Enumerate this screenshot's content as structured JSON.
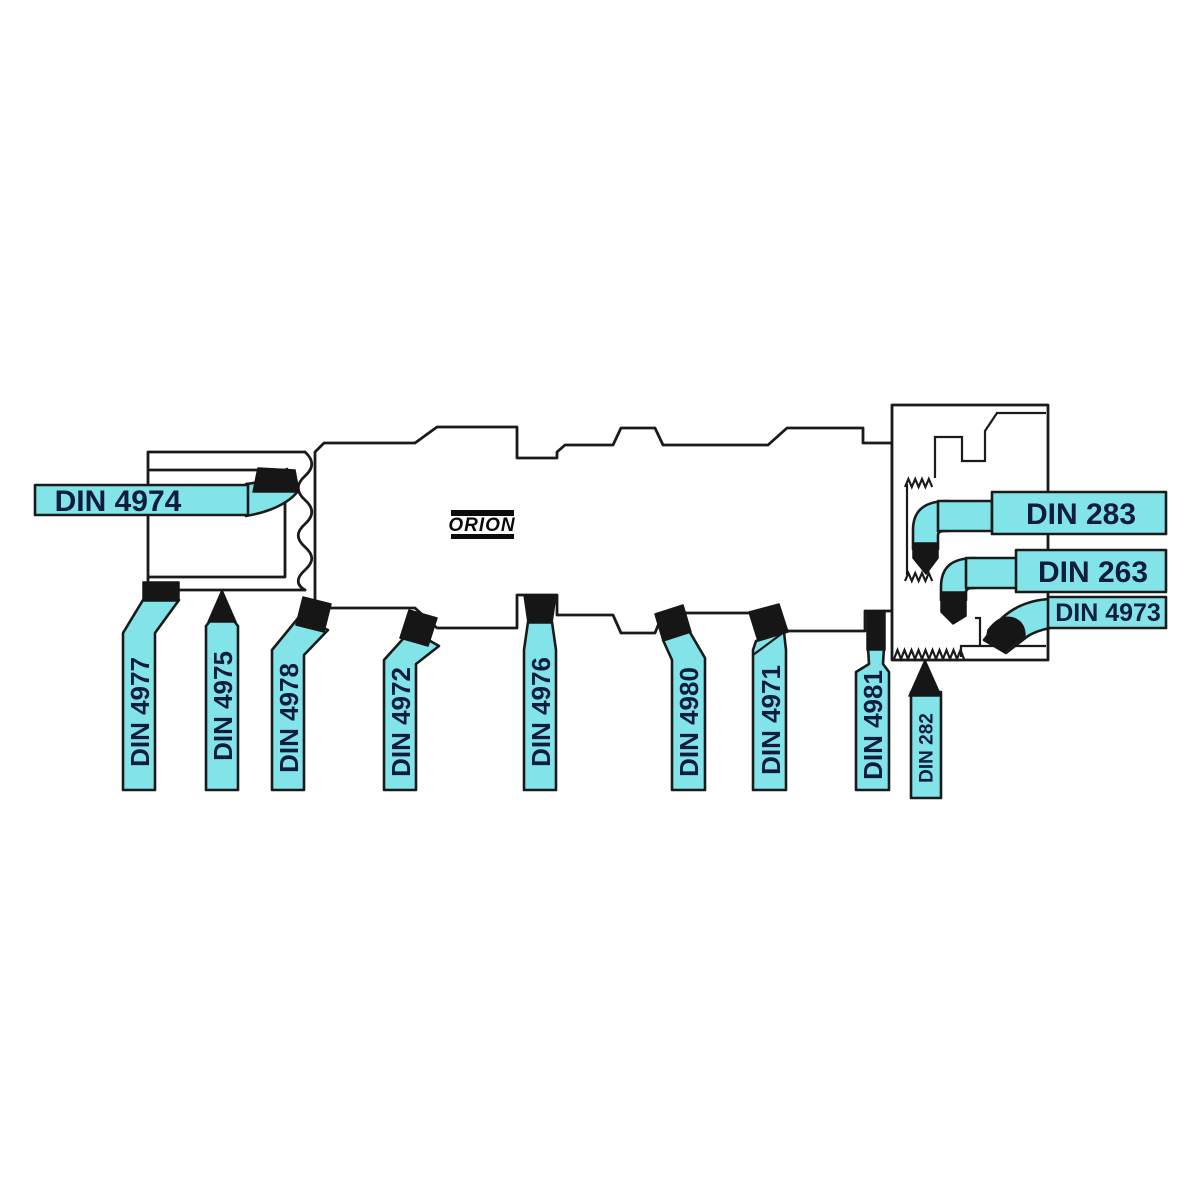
{
  "brand": {
    "name": "ORION"
  },
  "colors": {
    "tool_cyan": "#82e3e8",
    "outline_black": "#1a1a1a",
    "label_navy": "#0e1c3e",
    "tip_black": "#161616",
    "background": "#ffffff"
  },
  "tools": {
    "internal_boring": {
      "label": "DIN 4974"
    },
    "external": [
      {
        "label": "DIN 4977"
      },
      {
        "label": "DIN 4975"
      },
      {
        "label": "DIN 4978"
      },
      {
        "label": "DIN 4972"
      },
      {
        "label": "DIN 4976"
      },
      {
        "label": "DIN 4980"
      },
      {
        "label": "DIN 4971"
      },
      {
        "label": "DIN 4981"
      },
      {
        "label": "DIN 282"
      }
    ],
    "internal_right": [
      {
        "label": "DIN 283"
      },
      {
        "label": "DIN 263"
      },
      {
        "label": "DIN 4973"
      }
    ]
  }
}
